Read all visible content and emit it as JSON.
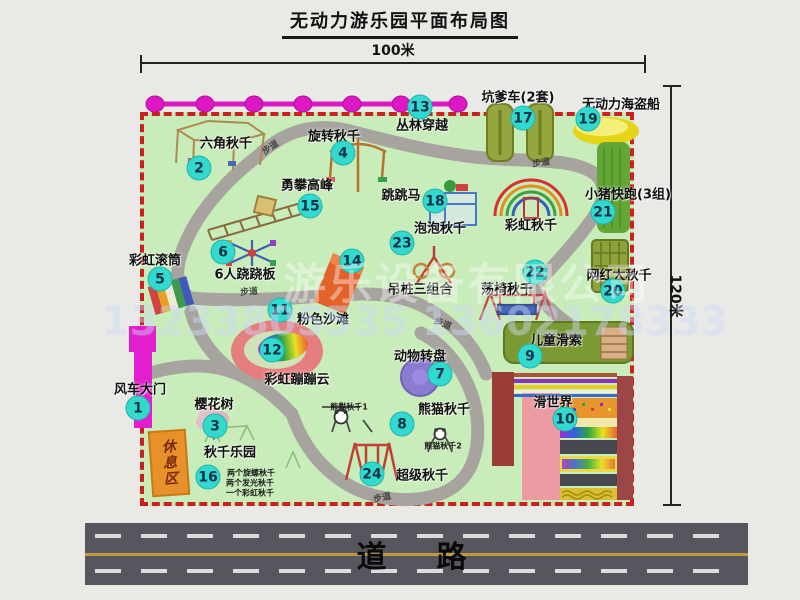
{
  "title": "无动力游乐园平面布局图",
  "dimensions": {
    "width_label": "100米",
    "height_label": "120米"
  },
  "road": {
    "label": "道　路"
  },
  "watermark": {
    "company": "游乐设备有限公司",
    "phone": "13233805535 13602178333"
  },
  "rest_area": {
    "label": "休息区"
  },
  "colors": {
    "map_green": "#c8ecba",
    "border_red": "#ce1f1f",
    "badge_cyan": "#32d9ce",
    "path_gray": "#a7a49f",
    "gate_magenta": "#e21ecf",
    "jungle_magenta": "#de17c4",
    "road_gray": "#56565e",
    "rest_orange": "#e8912a"
  },
  "attractions": [
    {
      "num": 1,
      "label": "风车大门",
      "badge": [
        138,
        408
      ],
      "label_pos": [
        140,
        388
      ]
    },
    {
      "num": 2,
      "label": "六角秋千",
      "badge": [
        199,
        168
      ],
      "label_pos": [
        226,
        142
      ]
    },
    {
      "num": 3,
      "label": "樱花树",
      "badge": [
        215,
        426
      ],
      "label_pos": [
        214,
        403
      ]
    },
    {
      "num": 4,
      "label": "旋转秋千",
      "badge": [
        343,
        153
      ],
      "label_pos": [
        334,
        135
      ]
    },
    {
      "num": 5,
      "label": "彩虹滚筒",
      "badge": [
        160,
        279
      ],
      "label_pos": [
        155,
        259
      ]
    },
    {
      "num": 6,
      "label": "6人跷跷板",
      "badge": [
        223,
        252
      ],
      "label_pos": [
        245,
        273
      ]
    },
    {
      "num": 7,
      "label": "动物转盘",
      "badge": [
        440,
        374
      ],
      "label_pos": [
        420,
        355
      ]
    },
    {
      "num": 8,
      "label": "熊猫秋千",
      "badge": [
        402,
        424
      ],
      "label_pos": [
        444,
        408
      ]
    },
    {
      "num": 9,
      "label": "儿童滑索",
      "badge": [
        530,
        356
      ],
      "label_pos": [
        556,
        339
      ]
    },
    {
      "num": 10,
      "label": "滑世界",
      "badge": [
        565,
        419
      ],
      "label_pos": [
        553,
        401
      ]
    },
    {
      "num": 11,
      "label": "粉色沙滩",
      "badge": [
        280,
        310
      ],
      "label_pos": [
        323,
        318
      ]
    },
    {
      "num": 12,
      "label": "彩虹蹦蹦云",
      "badge": [
        272,
        350
      ],
      "label_pos": [
        297,
        378
      ]
    },
    {
      "num": 13,
      "label": "丛林穿越",
      "badge": [
        420,
        107
      ],
      "label_pos": [
        422,
        124
      ]
    },
    {
      "num": 14,
      "label": "吊桩三组合",
      "badge": [
        352,
        261
      ],
      "label_pos": [
        420,
        288
      ]
    },
    {
      "num": 15,
      "label": "勇攀高峰",
      "badge": [
        310,
        206
      ],
      "label_pos": [
        307,
        184
      ]
    },
    {
      "num": 16,
      "label": "秋千乐园",
      "badge": [
        208,
        477
      ],
      "label_pos": [
        230,
        451
      ]
    },
    {
      "num": 17,
      "label": "坑爹车(2套)",
      "badge": [
        523,
        118
      ],
      "label_pos": [
        518,
        96
      ]
    },
    {
      "num": 18,
      "label": "跳跳马",
      "badge": [
        435,
        201
      ],
      "label_pos": [
        401,
        194
      ]
    },
    {
      "num": 19,
      "label": "无动力海盗船",
      "badge": [
        588,
        119
      ],
      "label_pos": [
        621,
        103
      ]
    },
    {
      "num": 20,
      "label": "网红大秋千",
      "badge": [
        613,
        291
      ],
      "label_pos": [
        619,
        274
      ]
    },
    {
      "num": 21,
      "label": "小猪快跑(3组)",
      "badge": [
        603,
        212
      ],
      "label_pos": [
        628,
        193
      ]
    },
    {
      "num": 22,
      "label": "荡椅秋千",
      "badge": [
        535,
        272
      ],
      "label_pos": [
        507,
        288
      ]
    },
    {
      "num": 23,
      "label": "泡泡秋千",
      "badge": [
        402,
        243
      ],
      "label_pos": [
        440,
        227
      ]
    },
    {
      "num": 24,
      "label": "超级秋千",
      "badge": [
        372,
        474
      ],
      "label_pos": [
        422,
        474
      ]
    }
  ],
  "extra_labels": [
    {
      "text": "彩虹秋千",
      "pos": [
        531,
        224
      ]
    }
  ],
  "walkway_labels": [
    {
      "text": "步道",
      "pos": [
        270,
        147
      ],
      "rot": -35
    },
    {
      "text": "步道",
      "pos": [
        541,
        162
      ],
      "rot": -8
    },
    {
      "text": "步道",
      "pos": [
        249,
        291
      ],
      "rot": -5
    },
    {
      "text": "步道",
      "pos": [
        443,
        323
      ],
      "rot": 22
    },
    {
      "text": "步道",
      "pos": [
        382,
        497
      ],
      "rot": -12
    }
  ],
  "notes": [
    {
      "text": "两个旋螺秋千",
      "pos": [
        251,
        473
      ]
    },
    {
      "text": "两个发光秋千",
      "pos": [
        250,
        483
      ]
    },
    {
      "text": "一个彩虹秋千",
      "pos": [
        250,
        493
      ]
    },
    {
      "text": "熊猫秋千1",
      "pos": [
        349,
        407
      ]
    },
    {
      "text": "熊猫秋千2",
      "pos": [
        443,
        446
      ]
    }
  ]
}
